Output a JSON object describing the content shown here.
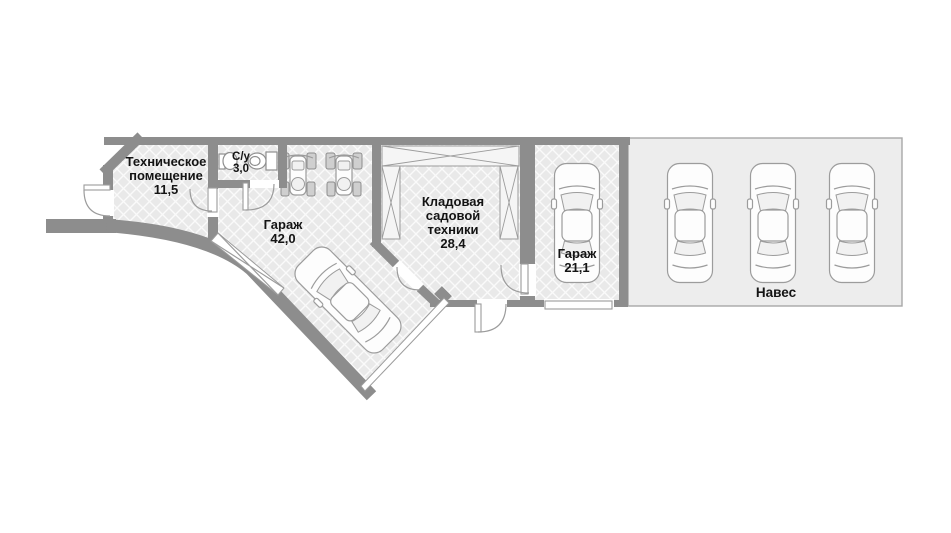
{
  "plan": {
    "type": "floor-plan",
    "language": "ru",
    "rooms": {
      "tech": {
        "name_line1": "Техническое",
        "name_line2": "помещение",
        "area": "11,5"
      },
      "bath": {
        "name": "С/у",
        "area": "3,0"
      },
      "garage_main": {
        "name": "Гараж",
        "area": "42,0"
      },
      "storage": {
        "name_line1": "Кладовая",
        "name_line2": "садовой",
        "name_line3": "техники",
        "area": "28,4"
      },
      "garage_small": {
        "name": "Гараж",
        "area": "21,1"
      },
      "canopy": {
        "name": "Навес"
      }
    },
    "vehicles": {
      "canopy_cars": 3,
      "garage_small_cars": 1,
      "garage_main_cars": 1,
      "garage_main_atvs": 2
    },
    "fixtures": [
      "sink",
      "toilet"
    ],
    "colors": {
      "wall": "#8d8d8d",
      "floor": "#e9e9e9",
      "hatch": "#fafafa",
      "bath": "#8ad3e6",
      "bath_hatch": "#c4ebf4",
      "canopy": "#ededed",
      "outline": "#9c9c9c",
      "text": "#141414"
    }
  }
}
